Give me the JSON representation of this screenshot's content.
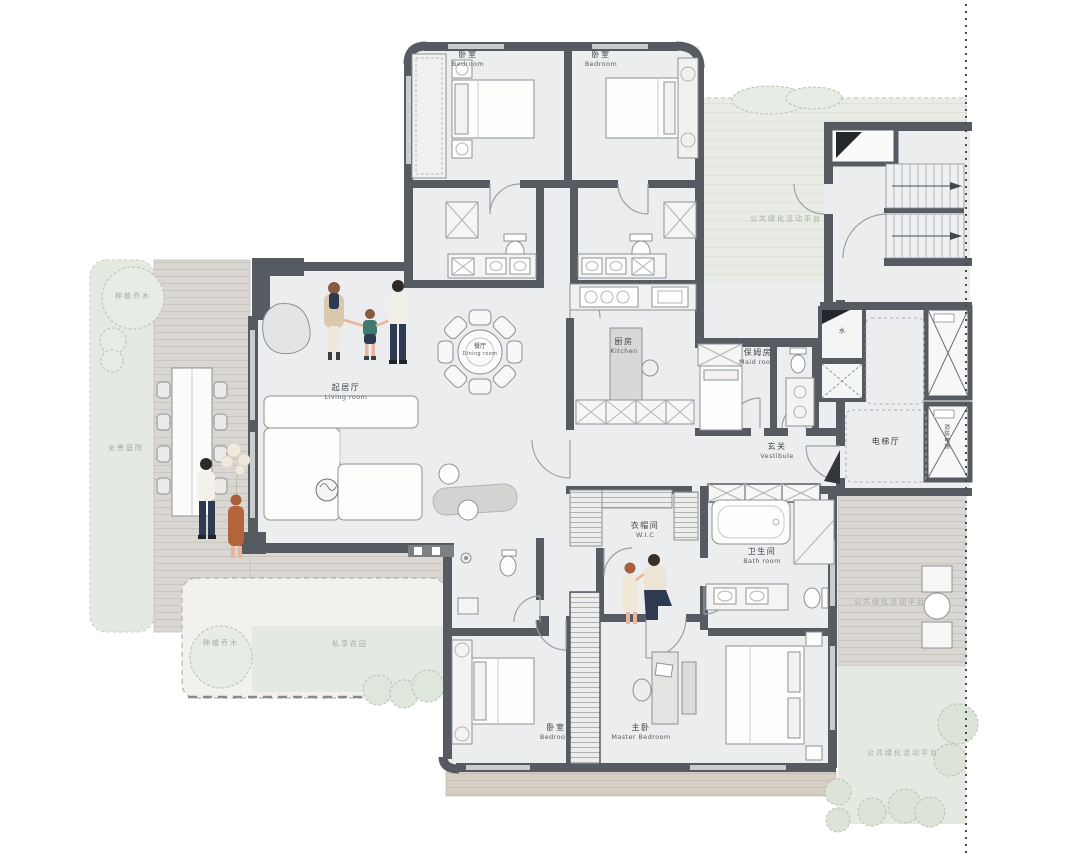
{
  "colors": {
    "wall": "#565b62",
    "floor": "#ecedee",
    "deck": "#dad7d2",
    "deck_line": "#c9c6c0",
    "green": "#e4eae1",
    "label": "#3f4449",
    "label_en": "#5a6065",
    "landscape_label": "#a4ac9f",
    "people_navy": "#2e3a52",
    "people_tan": "#d9c7ae",
    "people_rust": "#b4643c",
    "people_teal": "#3e7a70"
  },
  "rooms": {
    "bedroom_top_left": {
      "zh": "卧室",
      "en": "Bedroom"
    },
    "bedroom_top_right": {
      "zh": "卧室",
      "en": "Bedroom"
    },
    "living_room": {
      "zh": "起居厅",
      "en": "Living room"
    },
    "dining_room": {
      "zh": "餐厅",
      "en": "Dining room"
    },
    "kitchen": {
      "zh": "厨房",
      "en": "Kitchen"
    },
    "maid_room": {
      "zh": "保姆房",
      "en": "Maid room"
    },
    "vestibule": {
      "zh": "玄关",
      "en": "Vestibule"
    },
    "elevator_hall": {
      "zh": "电梯厅",
      "en": ""
    },
    "water": {
      "zh": "水",
      "en": ""
    },
    "fire_elevator": {
      "zh": "消防电梯",
      "en": ""
    },
    "wic": {
      "zh": "衣帽间",
      "en": "W.I.C"
    },
    "bath_room": {
      "zh": "卫生间",
      "en": "Bath room"
    },
    "bedroom_bottom": {
      "zh": "卧室",
      "en": "Bedroom"
    },
    "master_bedroom": {
      "zh": "主卧",
      "en": "Master Bedroom"
    }
  },
  "landscape": {
    "tree_top_left": {
      "zh": "种植乔木"
    },
    "garden_left": {
      "zh": "全景庭院"
    },
    "tree_bottom_left": {
      "zh": "种植乔木"
    },
    "garden_bottom": {
      "zh": "私享花园"
    },
    "platform_top": {
      "zh": "公共绿化活动平台"
    },
    "platform_right": {
      "zh": "公共绿化活动平台"
    },
    "platform_bottom": {
      "zh": "公共绿化活动平台"
    }
  }
}
